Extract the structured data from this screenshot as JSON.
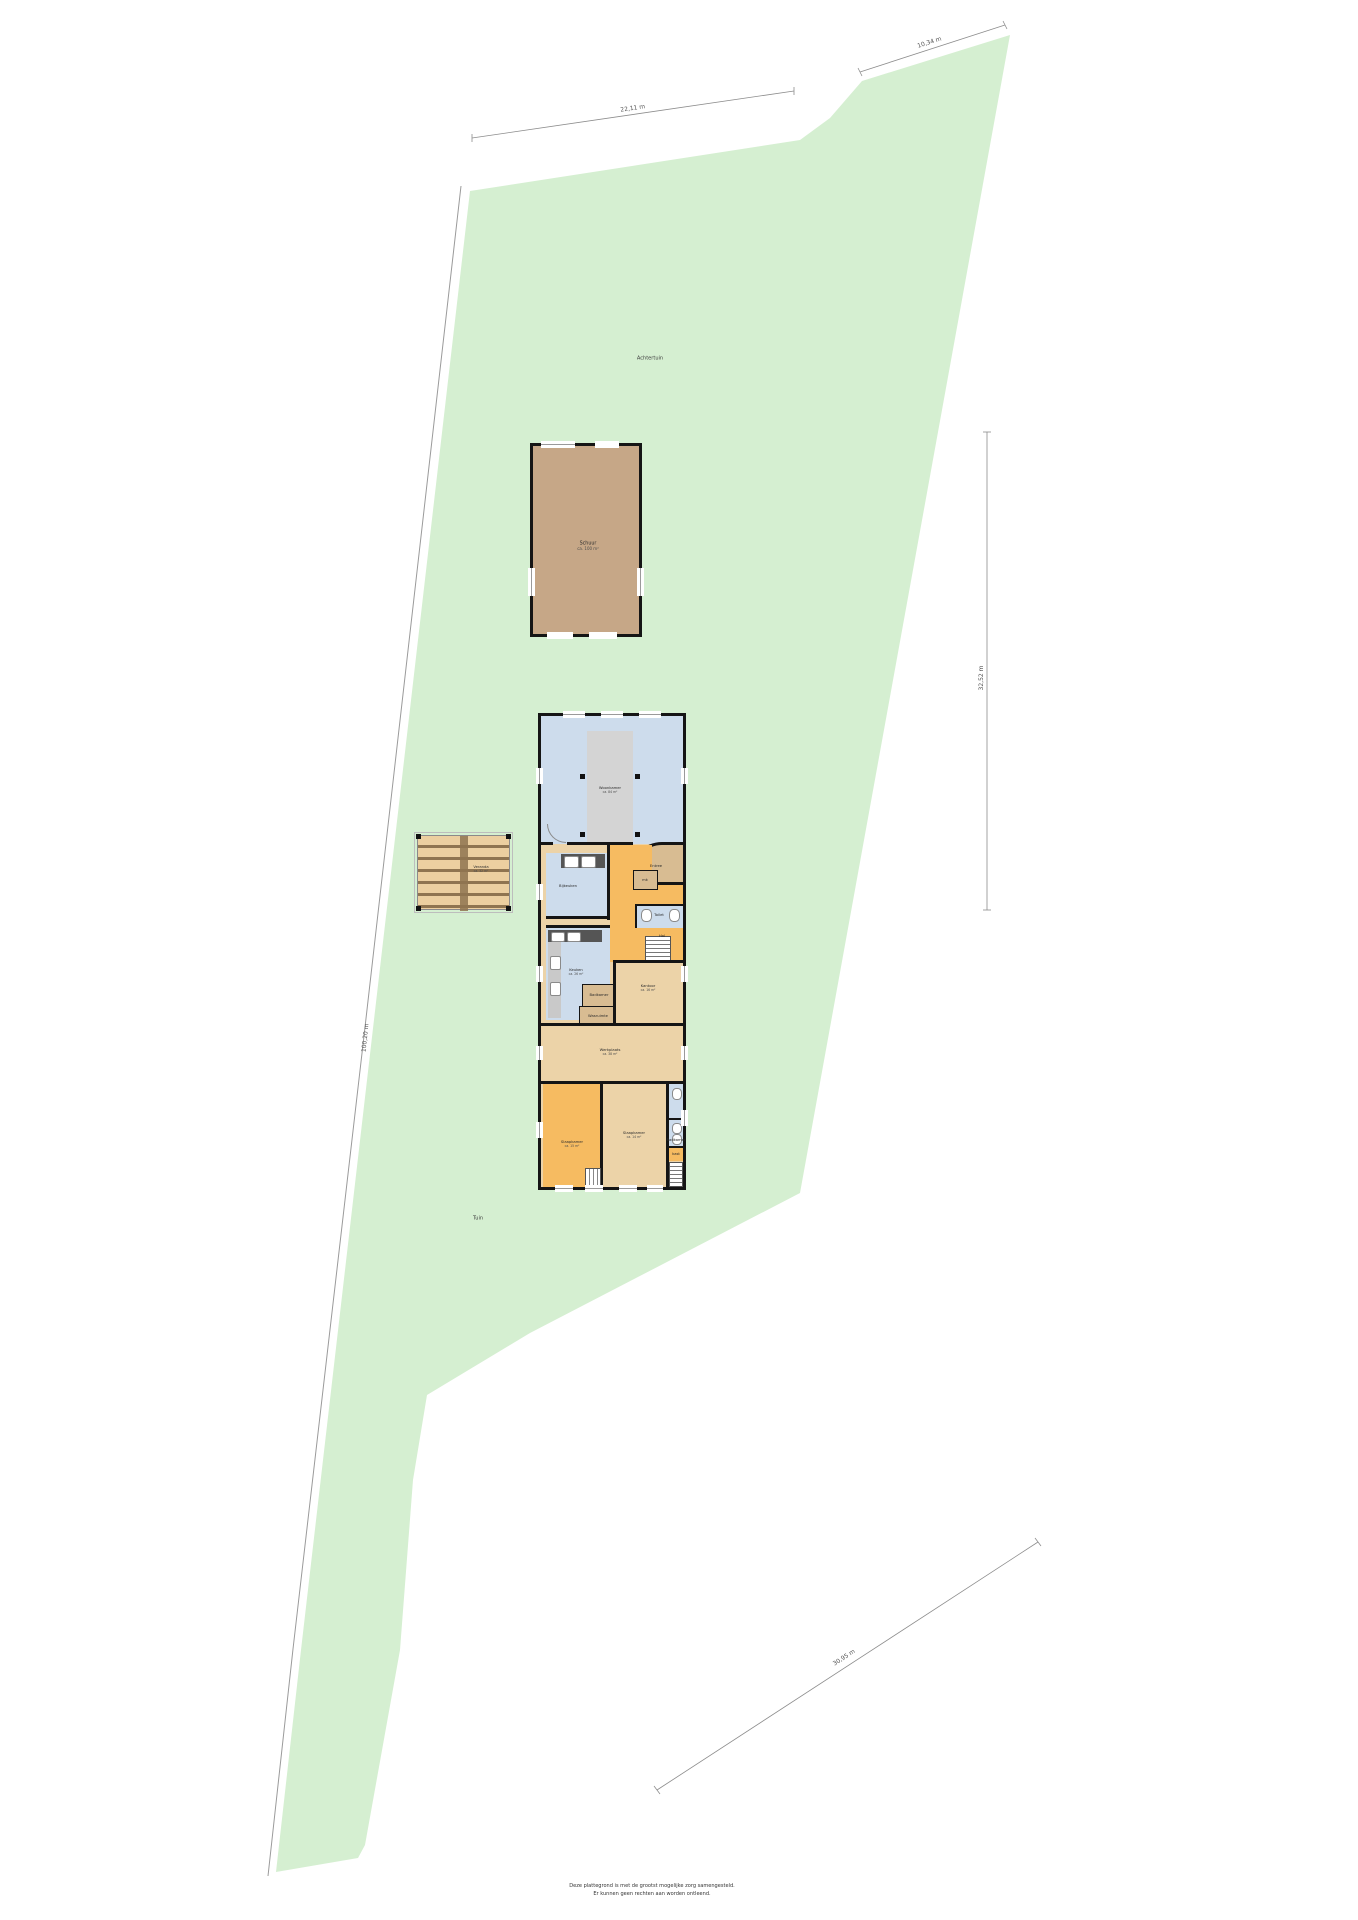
{
  "site": {
    "garden_back_label": "Achtertuin",
    "garden_front_label": "Tuin",
    "colors": {
      "plot_green": "#d5efd1",
      "barn_fill": "#c6a787",
      "room_blue": "#cddcec",
      "room_orange": "#f6bb61",
      "room_beige": "#ecd3a8",
      "room_brown": "#d8bc92",
      "wall_black": "#151515"
    }
  },
  "dimensions": {
    "top": "22,11 m",
    "top_right": "10,34 m",
    "right_side": "32,52 m",
    "left_side": "100,20 m",
    "bottom_right": "30,95 m"
  },
  "barn": {
    "name": "Schuur",
    "area": "ca. 100 m²"
  },
  "veranda": {
    "name": "Veranda",
    "area": "ca. 32 m²"
  },
  "house": {
    "rooms": {
      "woonkamer": {
        "name": "Woonkamer",
        "area": "ca. 84 m²"
      },
      "bijkeuken": {
        "name": "Bijkeuken"
      },
      "entree": {
        "name": "Entree"
      },
      "meterkast": {
        "name": "mk"
      },
      "toilet": {
        "name": "Toilet"
      },
      "hal": {
        "name": "Hal"
      },
      "keuken": {
        "name": "Keuken",
        "area": "ca. 26 m²"
      },
      "badkamer": {
        "name": "Badkamer"
      },
      "wasruimte": {
        "name": "Wasruimte"
      },
      "kantoor": {
        "name": "Kantoor",
        "area": "ca. 16 m²"
      },
      "werkplaats": {
        "name": "Werkplaats",
        "area": "ca. 38 m²"
      },
      "slaapkamer_1": {
        "name": "Slaapkamer",
        "area": "ca. 15 m²"
      },
      "slaapkamer_2": {
        "name": "Slaapkamer",
        "area": "ca. 14 m²"
      },
      "badkamer_2": {
        "name": "Badkamer"
      },
      "kast": {
        "name": "kast"
      }
    }
  },
  "footer": {
    "line1": "Deze plattegrond is met de grootst mogelijke zorg samengesteld.",
    "line2": "Er kunnen geen rechten aan worden ontleend."
  }
}
